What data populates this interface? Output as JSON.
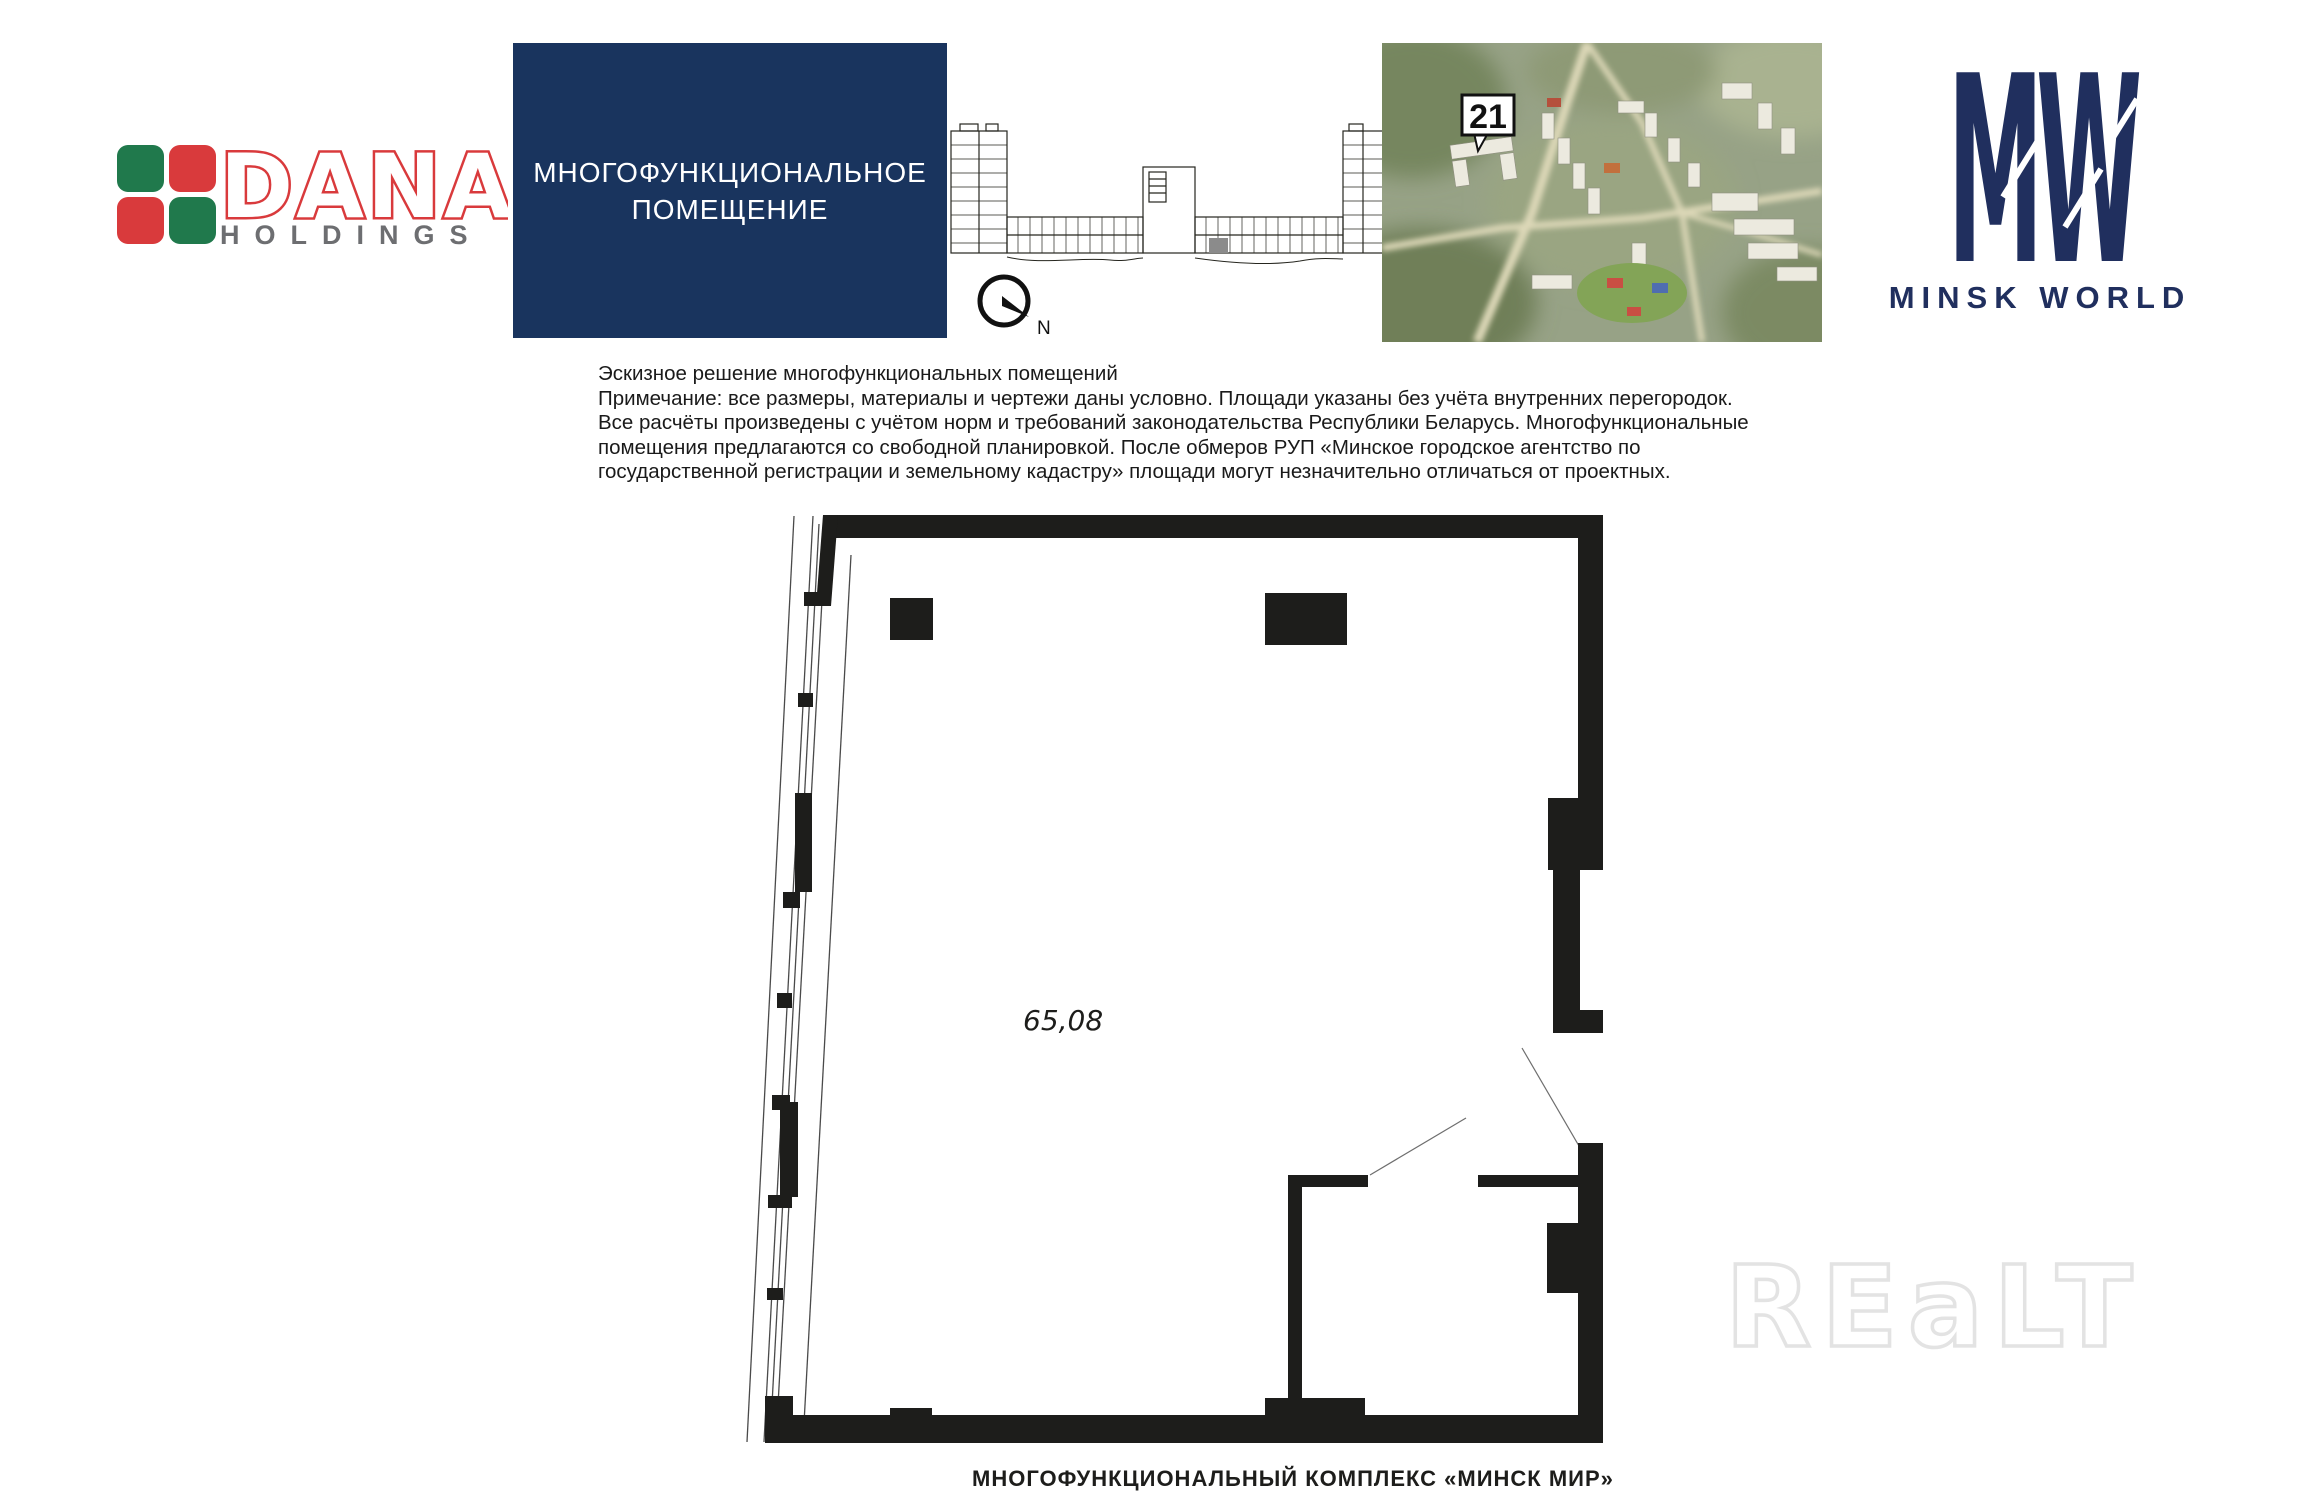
{
  "page": {
    "width": 2304,
    "height": 1476,
    "background": "#ffffff"
  },
  "dana_logo": {
    "wordmark": "DANA",
    "subtitle": "HOLDINGS",
    "red": "#d93a3c",
    "green": "#20794c",
    "gray": "#6d6e71",
    "squares": [
      "green",
      "red",
      "red",
      "green"
    ]
  },
  "title_box": {
    "line1": "МНОГОФУНКЦИОНАЛЬНОЕ",
    "line2": "ПОМЕЩЕНИЕ",
    "bg": "#19345e",
    "fg": "#ffffff"
  },
  "key_plan": {
    "compass_label": "N",
    "highlighted_unit_color": "#8b8b8b"
  },
  "aerial": {
    "badge_label": "21"
  },
  "minsk_world": {
    "monogram": "MW",
    "wordmark": "MINSK WORLD",
    "navy": "#202f5e"
  },
  "note": {
    "lines": [
      "Эскизное решение многофункциональных помещений",
      "Примечание: все размеры, материалы и чертежи даны условно. Площади указаны без учёта внутренних перегородок.",
      "Все расчёты произведены с учётом норм и требований законодательства Республики Беларусь. Многофункциональные",
      "помещения предлагаются со свободной планировкой. После обмеров РУП «Минское городское агентство по",
      "государственной регистрации и земельному кадастру» площади могут незначительно отличаться от проектных."
    ]
  },
  "floor_plan": {
    "area_label": "65,08",
    "ink": "#1d1d1b"
  },
  "watermark": {
    "text": "REaLT"
  },
  "footer": {
    "cropped_caption": "МНОГОФУНКЦИОНАЛЬНЫЙ КОМПЛЕКС «МИНСК МИР»"
  }
}
